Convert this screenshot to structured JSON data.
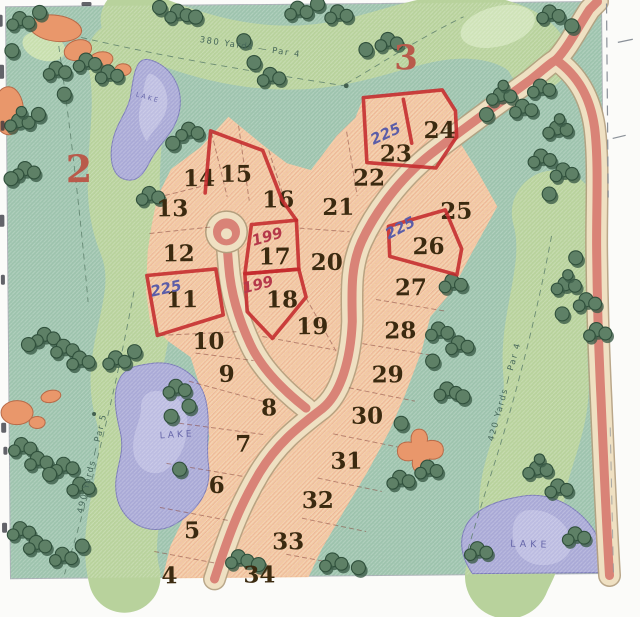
{
  "map": {
    "title": "Golf community lot plat (scanned hand-colored map)",
    "holes": {
      "hole_left": "2",
      "hole_top": "3"
    },
    "yardages": {
      "top": "380 Yards — Par 4",
      "right": "420 Yards — Par 4",
      "left": "490 Yards — Par 5"
    },
    "lake_label": "LAKE",
    "lots": [
      {
        "n": "4"
      },
      {
        "n": "5"
      },
      {
        "n": "6"
      },
      {
        "n": "7"
      },
      {
        "n": "8"
      },
      {
        "n": "9"
      },
      {
        "n": "10"
      },
      {
        "n": "11",
        "marked": true,
        "price": "225"
      },
      {
        "n": "12"
      },
      {
        "n": "13"
      },
      {
        "n": "14"
      },
      {
        "n": "15",
        "marked": true
      },
      {
        "n": "16"
      },
      {
        "n": "17",
        "marked": true,
        "price": "199"
      },
      {
        "n": "18",
        "marked": true,
        "price": "199"
      },
      {
        "n": "19"
      },
      {
        "n": "20"
      },
      {
        "n": "21"
      },
      {
        "n": "22"
      },
      {
        "n": "23",
        "marked": true,
        "price": "225"
      },
      {
        "n": "24",
        "marked": true
      },
      {
        "n": "25"
      },
      {
        "n": "26",
        "marked": true,
        "price": "225"
      },
      {
        "n": "27"
      },
      {
        "n": "28"
      },
      {
        "n": "29"
      },
      {
        "n": "30"
      },
      {
        "n": "31"
      },
      {
        "n": "32"
      },
      {
        "n": "33"
      },
      {
        "n": "34"
      }
    ],
    "colors": {
      "rough": "#9dc3ad",
      "fairway": "#b8d29c",
      "green_patch": "#cfe3b8",
      "lot_area": "#f2c9a2",
      "road_center": "#d98377",
      "road_edge": "#efe0c2",
      "lake": "#a9a9d6",
      "lake_light": "#c9c9e6",
      "tree": "#5e8066",
      "sand": "#e9976b",
      "marker_red": "#c42a2c",
      "ink_blue": "#5b5da8",
      "ink_red": "#b5384a"
    }
  }
}
